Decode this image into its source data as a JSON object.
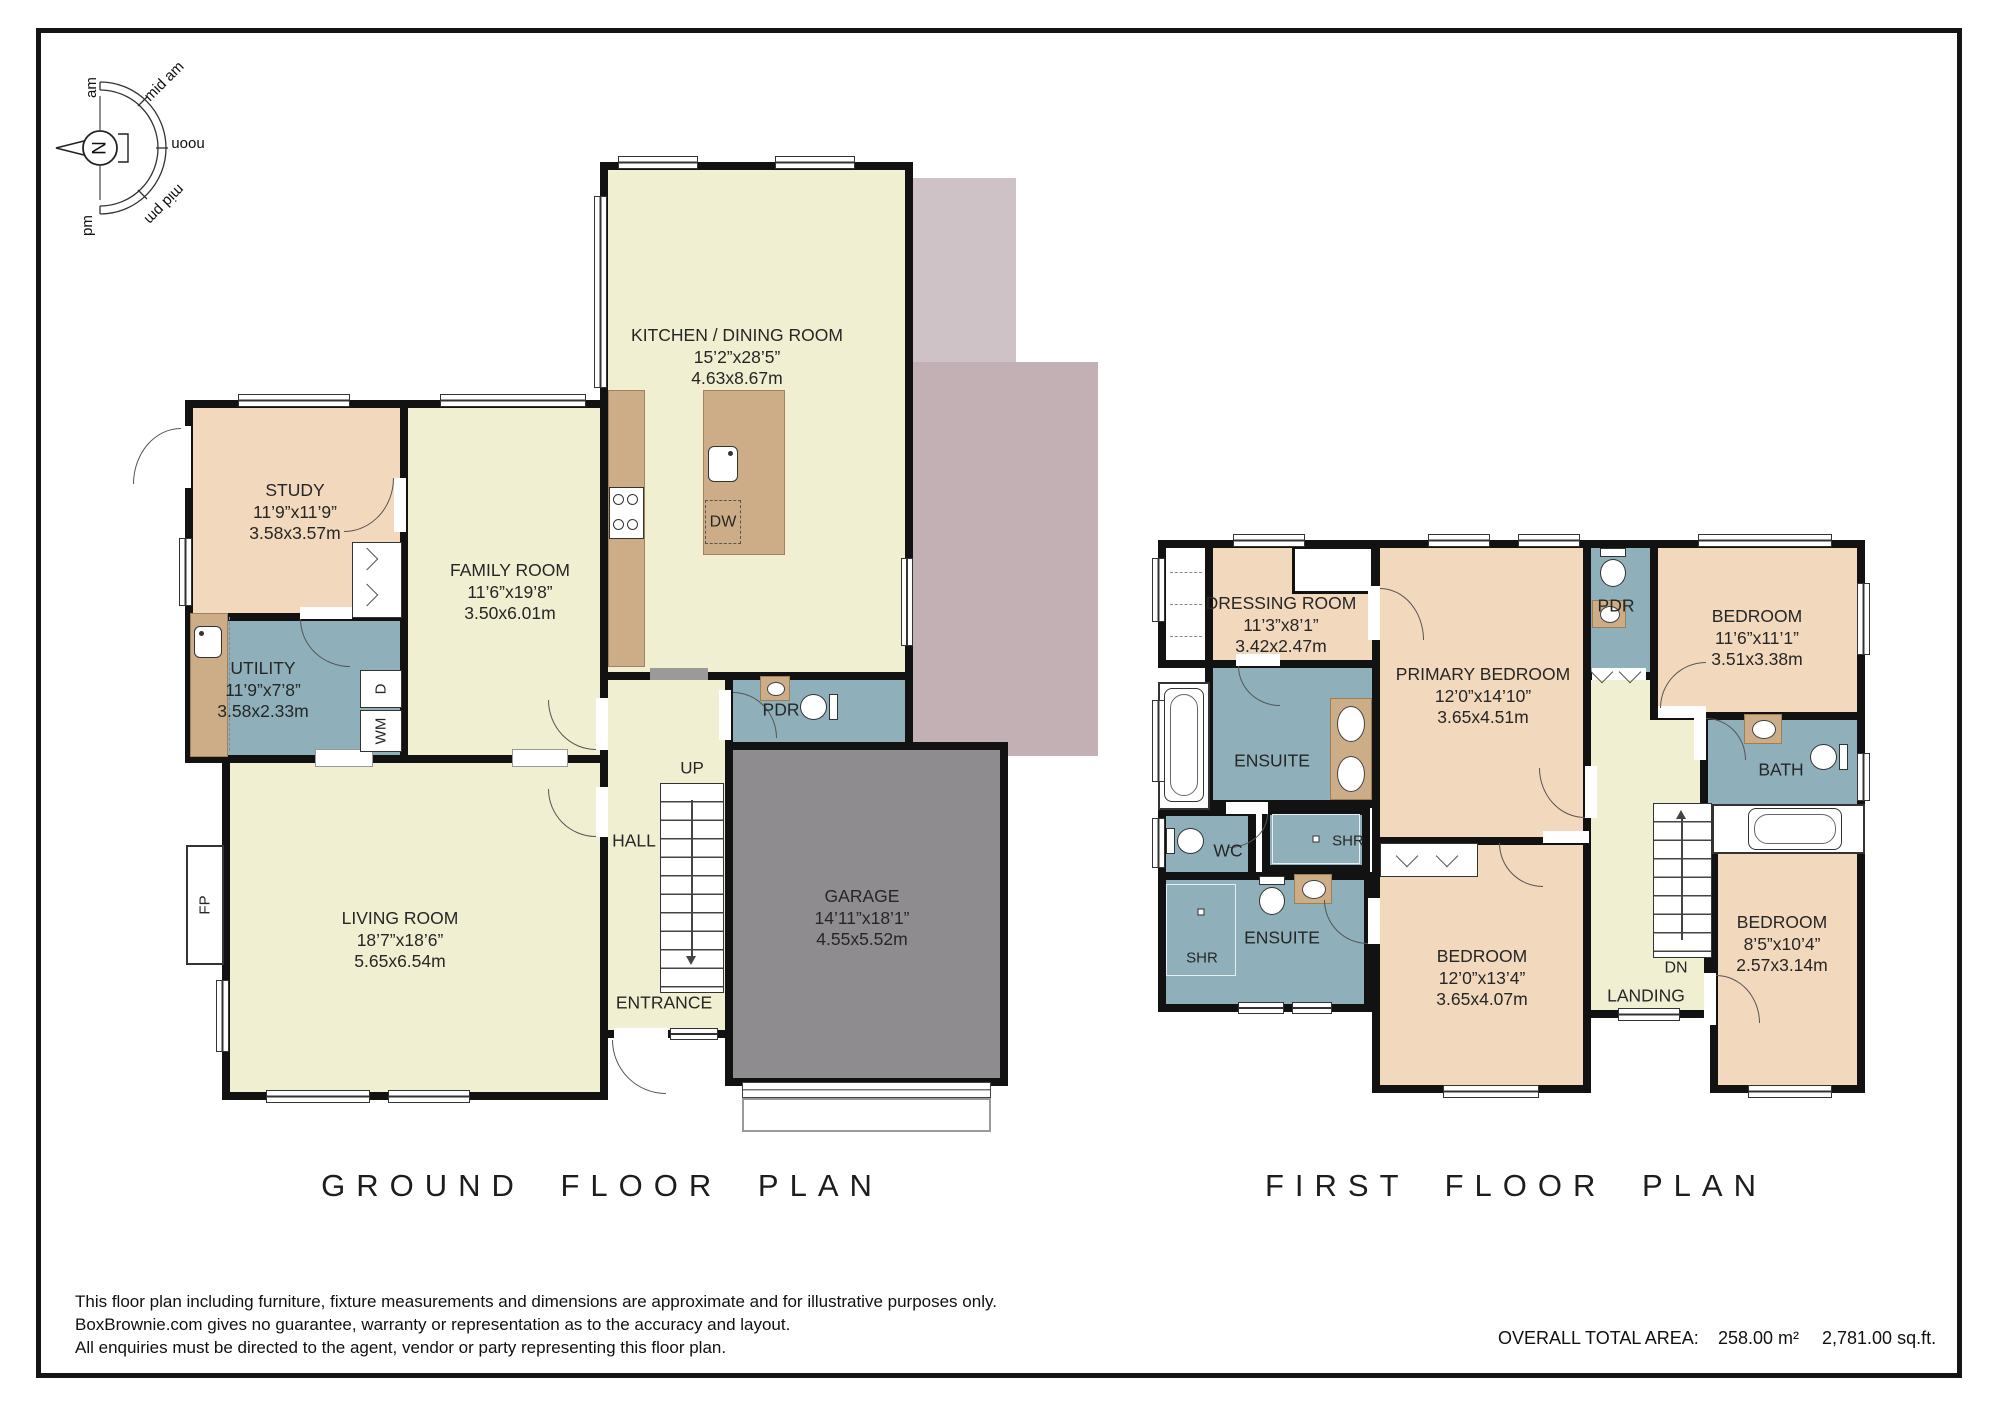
{
  "compass": {
    "north": "N",
    "labels": [
      "am",
      "mid am",
      "noon",
      "mid pm",
      "pm"
    ]
  },
  "ground": {
    "title": "GROUND FLOOR PLAN",
    "kitchen": {
      "name": "KITCHEN / DINING ROOM",
      "imperial": "15’2”x28’5”",
      "metric": "4.63x8.67m"
    },
    "study": {
      "name": "STUDY",
      "imperial": "11’9”x11’9”",
      "metric": "3.58x3.57m"
    },
    "family": {
      "name": "FAMILY ROOM",
      "imperial": "11’6”x19’8”",
      "metric": "3.50x6.01m"
    },
    "utility": {
      "name": "UTILITY",
      "imperial": "11’9”x7’8”",
      "metric": "3.58x2.33m"
    },
    "living": {
      "name": "LIVING ROOM",
      "imperial": "18’7”x18’6”",
      "metric": "5.65x6.54m"
    },
    "garage": {
      "name": "GARAGE",
      "imperial": "14’11”x18’1”",
      "metric": "4.55x5.52m"
    },
    "hall": "HALL",
    "entrance": "ENTRANCE",
    "pdr": "PDR",
    "up": "UP",
    "fp": "FP",
    "dw": "DW",
    "dryer": "D",
    "washer": "WM"
  },
  "first": {
    "title": "FIRST FLOOR PLAN",
    "dressing": {
      "name": "DRESSING ROOM",
      "imperial": "11’3”x8’1”",
      "metric": "3.42x2.47m"
    },
    "primary": {
      "name": "PRIMARY BEDROOM",
      "imperial": "12’0”x14’10”",
      "metric": "3.65x4.51m"
    },
    "bedroom_tr": {
      "name": "BEDROOM",
      "imperial": "11’6”x11’1”",
      "metric": "3.51x3.38m"
    },
    "bedroom_bc": {
      "name": "BEDROOM",
      "imperial": "12’0”x13’4”",
      "metric": "3.65x4.07m"
    },
    "bedroom_br": {
      "name": "BEDROOM",
      "imperial": "8’5”x10’4”",
      "metric": "2.57x3.14m"
    },
    "ensuite_top": "ENSUITE",
    "ensuite_bottom": "ENSUITE",
    "wc": "WC",
    "bath": "BATH",
    "pdr": "PDR",
    "landing": "LANDING",
    "shr_top": "SHR",
    "shr_bottom": "SHR",
    "dn": "DN"
  },
  "footer": {
    "disclaimer": [
      "This floor plan including furniture, fixture measurements and dimensions are approximate and for illustrative purposes only.",
      "BoxBrownie.com gives no guarantee, warranty or representation as to the accuracy and layout.",
      "All enquiries must be directed to the agent, vendor or party representing this floor plan."
    ],
    "total_area_label": "OVERALL TOTAL AREA:",
    "total_area_metric": "258.00 m²",
    "total_area_imperial": "2,781.00 sq.ft."
  },
  "colors": {
    "living_area": "#f1efd2",
    "bedroom": "#f2d8bd",
    "wet_room": "#8fb0ba",
    "garage": "#8e8c8f",
    "patio_light": "#cfc2c6",
    "patio_dark": "#c2b0b5",
    "counter": "#cdad87",
    "wall": "#121212"
  }
}
